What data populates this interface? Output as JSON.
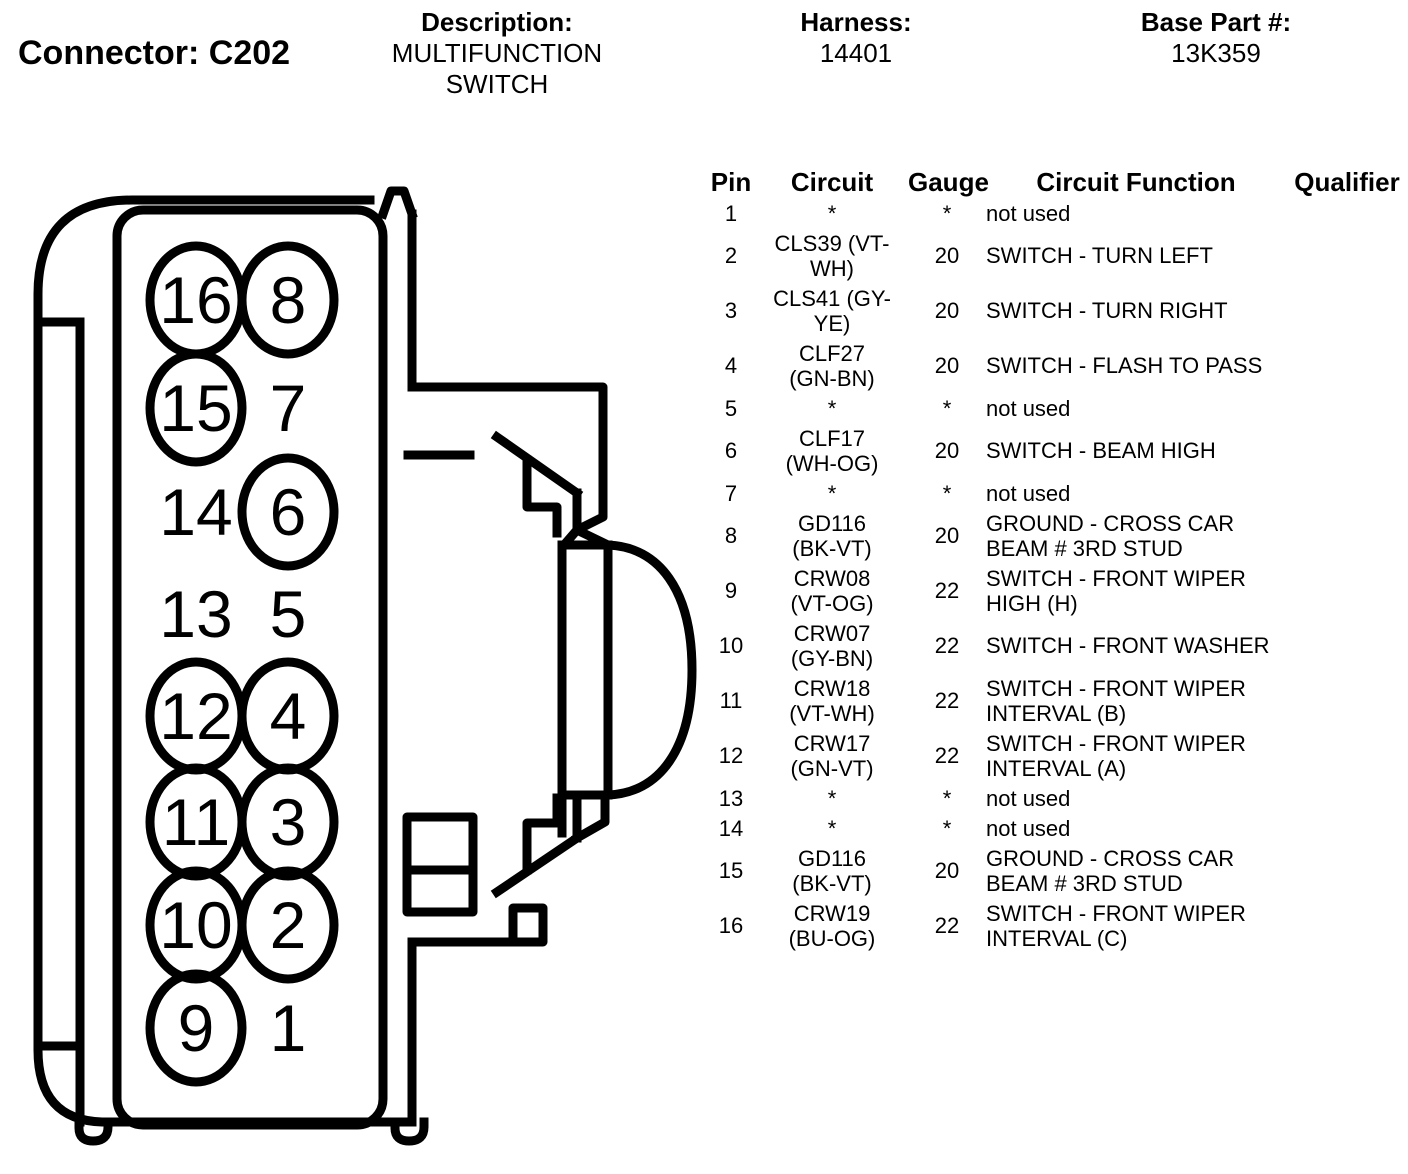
{
  "page": {
    "background": "#ffffff",
    "ink": "#000000"
  },
  "header": {
    "connector_label": "Connector: C202",
    "description_label": "Description:",
    "description_value": "MULTIFUNCTION SWITCH",
    "harness_label": "Harness:",
    "harness_value": "14401",
    "base_part_label": "Base Part #:",
    "base_part_value": "13K359"
  },
  "diagram": {
    "pins": [
      {
        "label": "16",
        "row": 0,
        "col": 0,
        "circled": true
      },
      {
        "label": "8",
        "row": 0,
        "col": 1,
        "circled": true
      },
      {
        "label": "15",
        "row": 1,
        "col": 0,
        "circled": true
      },
      {
        "label": "7",
        "row": 1,
        "col": 1,
        "circled": false
      },
      {
        "label": "14",
        "row": 2,
        "col": 0,
        "circled": false
      },
      {
        "label": "6",
        "row": 2,
        "col": 1,
        "circled": true
      },
      {
        "label": "13",
        "row": 3,
        "col": 0,
        "circled": false
      },
      {
        "label": "5",
        "row": 3,
        "col": 1,
        "circled": false
      },
      {
        "label": "12",
        "row": 4,
        "col": 0,
        "circled": true
      },
      {
        "label": "4",
        "row": 4,
        "col": 1,
        "circled": true
      },
      {
        "label": "11",
        "row": 5,
        "col": 0,
        "circled": true
      },
      {
        "label": "3",
        "row": 5,
        "col": 1,
        "circled": true
      },
      {
        "label": "10",
        "row": 6,
        "col": 0,
        "circled": true
      },
      {
        "label": "2",
        "row": 6,
        "col": 1,
        "circled": true
      },
      {
        "label": "9",
        "row": 7,
        "col": 0,
        "circled": true
      },
      {
        "label": "1",
        "row": 7,
        "col": 1,
        "circled": false
      }
    ]
  },
  "table": {
    "columns": [
      "Pin",
      "Circuit",
      "Gauge",
      "Circuit Function",
      "Qualifier"
    ],
    "rows": [
      {
        "pin": "1",
        "circuit": "*",
        "gauge": "*",
        "function": "not used",
        "qualifier": ""
      },
      {
        "pin": "2",
        "circuit": "CLS39 (VT-WH)",
        "gauge": "20",
        "function": "SWITCH - TURN LEFT",
        "qualifier": ""
      },
      {
        "pin": "3",
        "circuit": "CLS41 (GY-YE)",
        "gauge": "20",
        "function": "SWITCH - TURN RIGHT",
        "qualifier": ""
      },
      {
        "pin": "4",
        "circuit": "CLF27 (GN-BN)",
        "gauge": "20",
        "function": "SWITCH - FLASH TO PASS",
        "qualifier": ""
      },
      {
        "pin": "5",
        "circuit": "*",
        "gauge": "*",
        "function": "not used",
        "qualifier": ""
      },
      {
        "pin": "6",
        "circuit": "CLF17 (WH-OG)",
        "gauge": "20",
        "function": "SWITCH - BEAM HIGH",
        "qualifier": ""
      },
      {
        "pin": "7",
        "circuit": "*",
        "gauge": "*",
        "function": "not used",
        "qualifier": ""
      },
      {
        "pin": "8",
        "circuit": "GD116 (BK-VT)",
        "gauge": "20",
        "function": "GROUND - CROSS CAR BEAM # 3RD STUD",
        "qualifier": ""
      },
      {
        "pin": "9",
        "circuit": "CRW08 (VT-OG)",
        "gauge": "22",
        "function": "SWITCH - FRONT WIPER HIGH (H)",
        "qualifier": ""
      },
      {
        "pin": "10",
        "circuit": "CRW07 (GY-BN)",
        "gauge": "22",
        "function": "SWITCH - FRONT WASHER",
        "qualifier": ""
      },
      {
        "pin": "11",
        "circuit": "CRW18 (VT-WH)",
        "gauge": "22",
        "function": "SWITCH - FRONT WIPER INTERVAL (B)",
        "qualifier": ""
      },
      {
        "pin": "12",
        "circuit": "CRW17 (GN-VT)",
        "gauge": "22",
        "function": "SWITCH - FRONT WIPER INTERVAL (A)",
        "qualifier": ""
      },
      {
        "pin": "13",
        "circuit": "*",
        "gauge": "*",
        "function": "not used",
        "qualifier": ""
      },
      {
        "pin": "14",
        "circuit": "*",
        "gauge": "*",
        "function": "not used",
        "qualifier": ""
      },
      {
        "pin": "15",
        "circuit": "GD116 (BK-VT)",
        "gauge": "20",
        "function": "GROUND - CROSS CAR BEAM # 3RD STUD",
        "qualifier": ""
      },
      {
        "pin": "16",
        "circuit": "CRW19 (BU-OG)",
        "gauge": "22",
        "function": "SWITCH - FRONT WIPER INTERVAL (C)",
        "qualifier": ""
      }
    ]
  }
}
